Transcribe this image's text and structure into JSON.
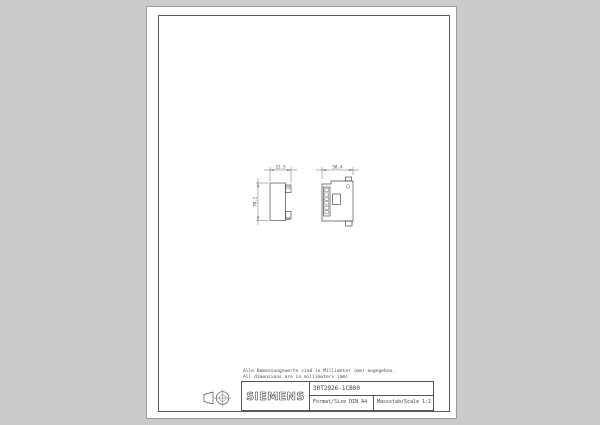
{
  "page": {
    "background_color": "#cbcbcb",
    "paper_color": "#ffffff",
    "line_color": "#4d4d4d"
  },
  "notes": {
    "line1": "Alle Bemessungswerte sind in Millimeter (mm) angegeben.",
    "line2": "All dimensions are in millimeters (mm)"
  },
  "dimensions": {
    "side_view_width": "22.5",
    "side_view_height": "70.2",
    "front_view_width": "58.4"
  },
  "title_block": {
    "logo": "SIEMENS",
    "part_number": "3RT2926-1CB00",
    "format_label": "Format/Size DIN A4",
    "scale_label": "Massstab/Scale 1:1"
  },
  "icons": {
    "projection": "first-angle-projection-symbol"
  }
}
